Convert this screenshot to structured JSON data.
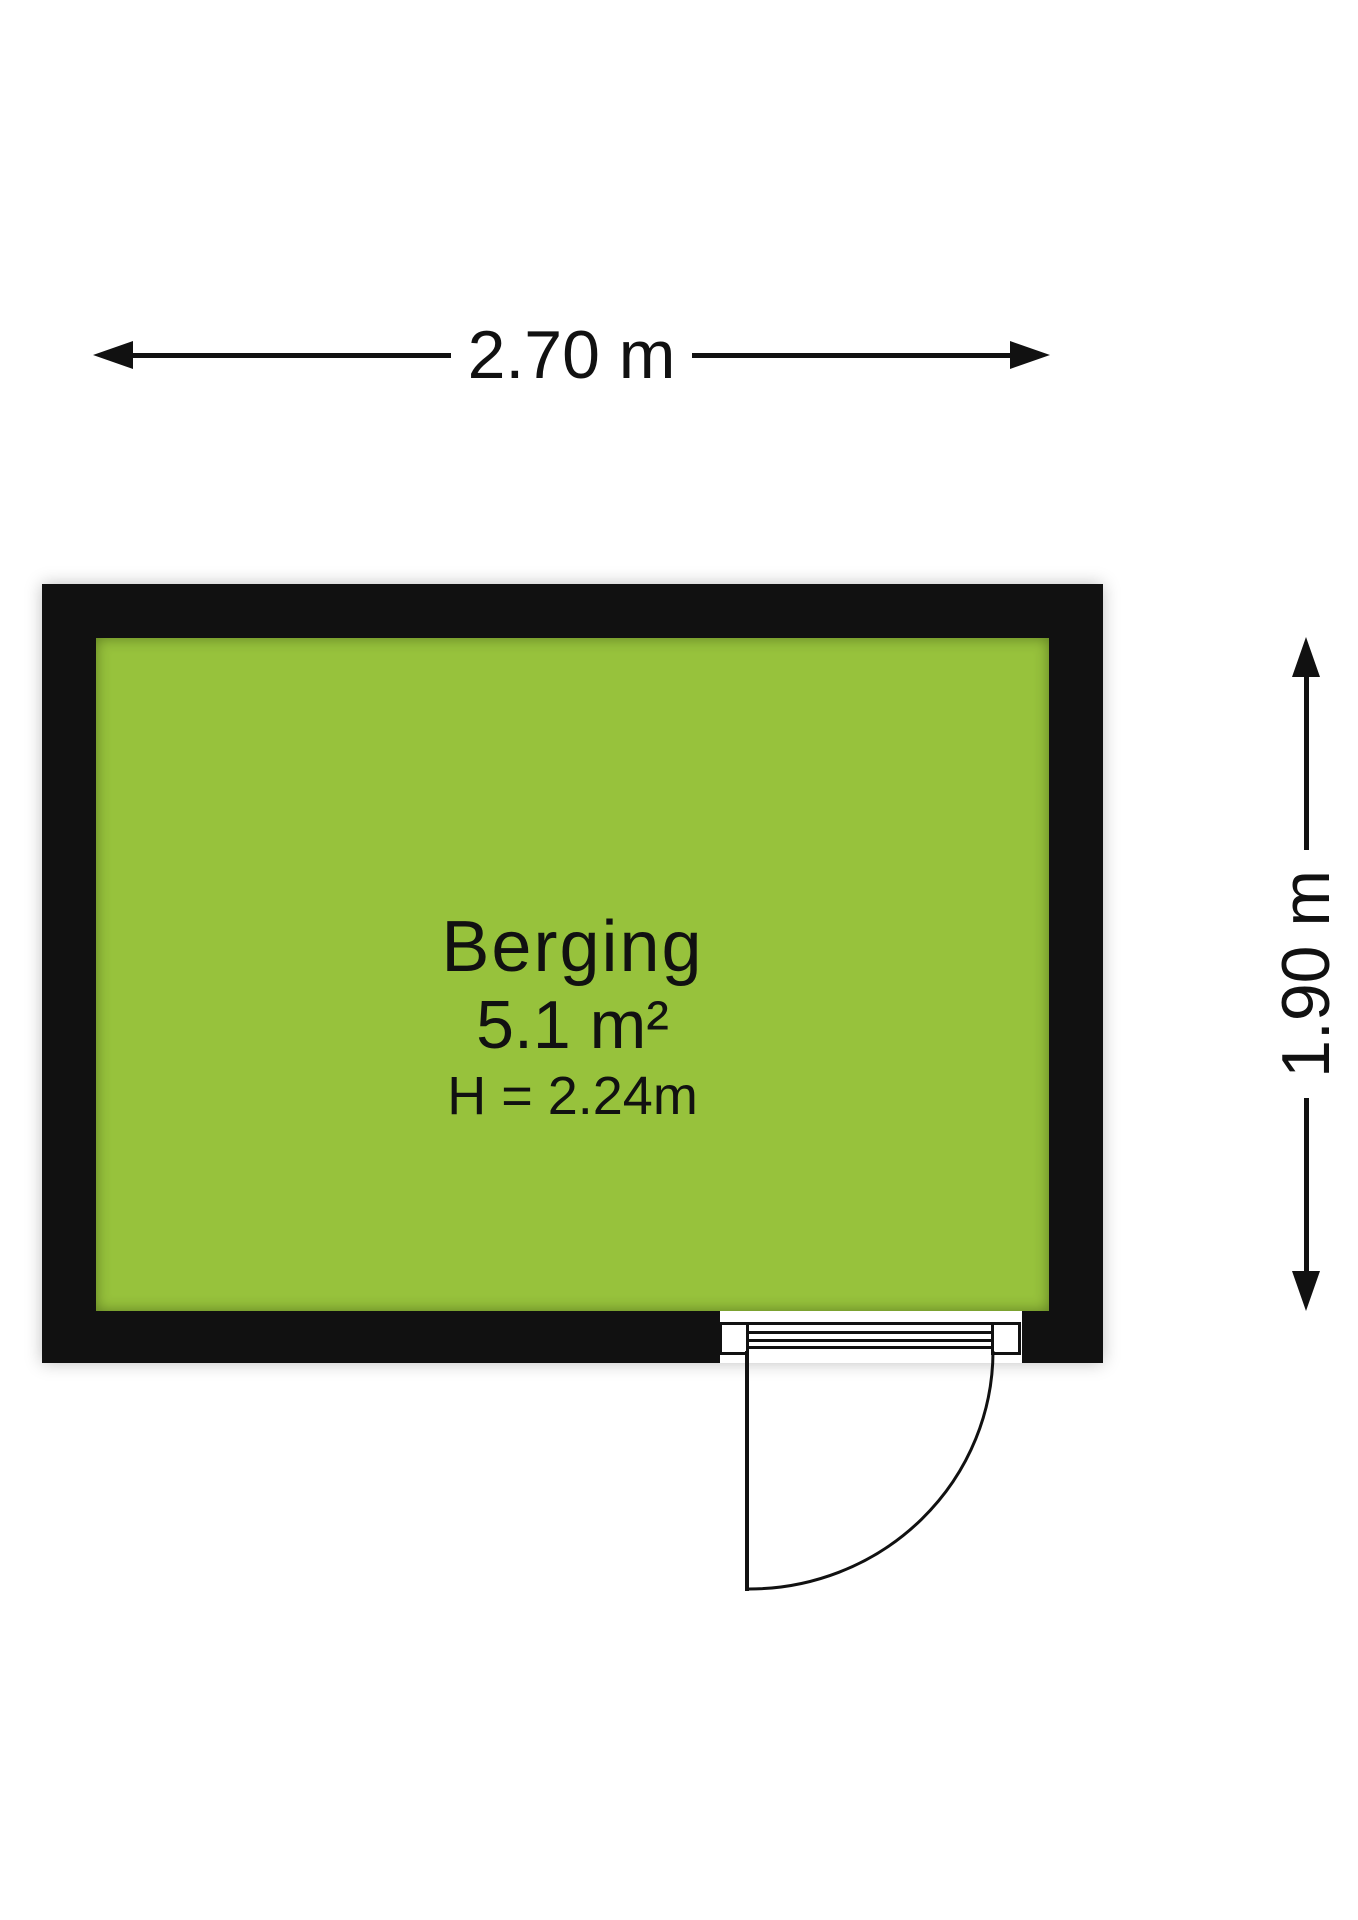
{
  "room": {
    "name": "Berging",
    "area": "5.1 m²",
    "ceiling_height": "H = 2.24m"
  },
  "dimensions": {
    "width": "2.70 m",
    "height": "1.90 m"
  },
  "colors": {
    "floor_fill": "#97C23C",
    "wall": "#111111",
    "line": "#111111"
  }
}
